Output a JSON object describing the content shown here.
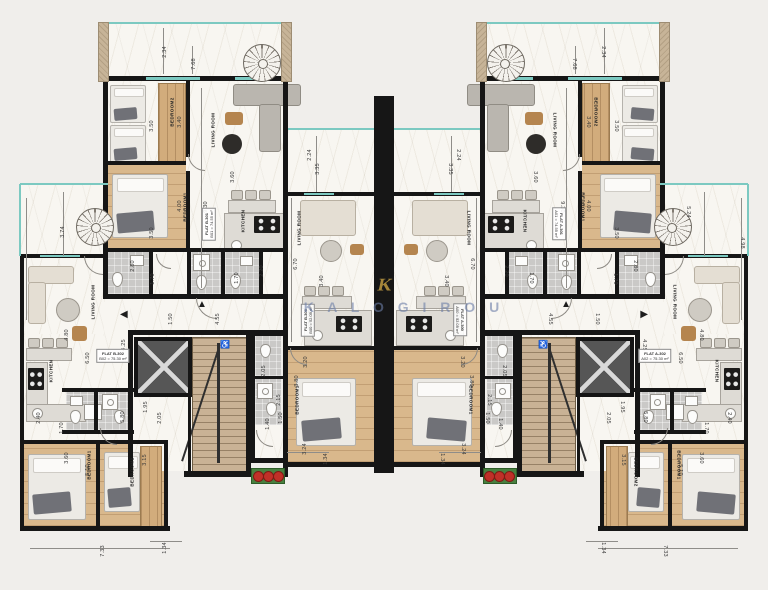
{
  "palette": {
    "wall": "#161616",
    "glass": "#7cc9c1",
    "wood": "#d9b88c",
    "gold": "#c9a344",
    "watermark": "#6c7ea8",
    "planter": "#48803f",
    "dot": "#c03028"
  },
  "watermark": {
    "text": "K A L O G I R O U",
    "logo": "K"
  },
  "glyphs": {
    "up_arrow": "▲",
    "side_arrow": "◀",
    "wheelchair": "♿"
  },
  "flat_labels": [
    {
      "l1": "FLAT B-301",
      "l2": "B01 = 74.55 m²",
      "x": 209,
      "y": 224,
      "r": -90
    },
    {
      "l1": "FLAT B-300",
      "l2": "B00 = 52.09 m²",
      "x": 308,
      "y": 320,
      "r": -90
    },
    {
      "l1": "FLAT B-302",
      "l2": "B02 = 75.30 m²",
      "x": 113,
      "y": 356,
      "r": 0
    },
    {
      "l1": "FLAT A-301",
      "l2": "A01 = 74.55 m²",
      "x": 559,
      "y": 224,
      "r": 90
    },
    {
      "l1": "FLAT A-300",
      "l2": "A00 = 52.09 m²",
      "x": 460,
      "y": 320,
      "r": 90
    },
    {
      "l1": "FLAT A-302",
      "l2": "A02 = 75.30 m²",
      "x": 655,
      "y": 356,
      "r": 0
    }
  ],
  "room_labels": [
    {
      "t": "BEDROOM2",
      "x": 172,
      "y": 112
    },
    {
      "t": "BEDROOM1",
      "x": 185,
      "y": 207
    },
    {
      "t": "LIVING ROOM",
      "x": 213,
      "y": 130
    },
    {
      "t": "KITCHEN",
      "x": 243,
      "y": 221
    },
    {
      "t": "LIVING ROOM",
      "x": 299,
      "y": 228
    },
    {
      "t": "KITCHEN",
      "x": 310,
      "y": 318
    },
    {
      "t": "BEDROOM1",
      "x": 297,
      "y": 400
    },
    {
      "t": "LIVING ROOM",
      "x": 93,
      "y": 302
    },
    {
      "t": "KITCHEN",
      "x": 51,
      "y": 371
    },
    {
      "t": "BEDROOM1",
      "x": 89,
      "y": 465
    },
    {
      "t": "BEDROOM2",
      "x": 132,
      "y": 472
    }
  ],
  "dim_labels": [
    {
      "t": "2.34",
      "x": 165,
      "y": 52
    },
    {
      "t": "7.68",
      "x": 194,
      "y": 64
    },
    {
      "t": "3.50",
      "x": 152,
      "y": 126
    },
    {
      "t": "3.40",
      "x": 180,
      "y": 122
    },
    {
      "t": "4.00",
      "x": 180,
      "y": 206
    },
    {
      "t": "3.50",
      "x": 152,
      "y": 233
    },
    {
      "t": "3.60",
      "x": 233,
      "y": 177
    },
    {
      "t": "9.30",
      "x": 206,
      "y": 207
    },
    {
      "t": "2.80",
      "x": 133,
      "y": 266
    },
    {
      "t": "1.70",
      "x": 153,
      "y": 279
    },
    {
      "t": "1.70",
      "x": 237,
      "y": 278
    },
    {
      "t": "2.20",
      "x": 262,
      "y": 271
    },
    {
      "t": "2.24",
      "x": 310,
      "y": 155
    },
    {
      "t": "3.35",
      "x": 318,
      "y": 169
    },
    {
      "t": "6.70",
      "x": 296,
      "y": 264
    },
    {
      "t": "3.40",
      "x": 322,
      "y": 281
    },
    {
      "t": "3.20",
      "x": 306,
      "y": 362
    },
    {
      "t": "3.80",
      "x": 297,
      "y": 381
    },
    {
      "t": "2.05",
      "x": 264,
      "y": 371
    },
    {
      "t": "2.15",
      "x": 279,
      "y": 400
    },
    {
      "t": "1.50",
      "x": 281,
      "y": 418
    },
    {
      "t": "1.40",
      "x": 268,
      "y": 424
    },
    {
      "t": "3.24",
      "x": 305,
      "y": 449
    },
    {
      "t": "1.34",
      "x": 326,
      "y": 459
    },
    {
      "t": "1.50",
      "x": 171,
      "y": 319
    },
    {
      "t": "4.55",
      "x": 218,
      "y": 319
    },
    {
      "t": "4.80",
      "x": 67,
      "y": 335
    },
    {
      "t": "4.25",
      "x": 124,
      "y": 345
    },
    {
      "t": "6.50",
      "x": 88,
      "y": 358
    },
    {
      "t": "2.40",
      "x": 39,
      "y": 418
    },
    {
      "t": "1.70",
      "x": 62,
      "y": 428
    },
    {
      "t": "5.80",
      "x": 123,
      "y": 417
    },
    {
      "t": "1.95",
      "x": 146,
      "y": 407
    },
    {
      "t": "2.05",
      "x": 160,
      "y": 418
    },
    {
      "t": "3.60",
      "x": 67,
      "y": 458
    },
    {
      "t": "5.10",
      "x": 88,
      "y": 470
    },
    {
      "t": "3.15",
      "x": 145,
      "y": 460
    },
    {
      "t": "7.33",
      "x": 103,
      "y": 551
    },
    {
      "t": "1.34",
      "x": 165,
      "y": 548
    },
    {
      "t": "3.74",
      "x": 63,
      "y": 232,
      "m": false
    },
    {
      "t": "4.98",
      "x": 742,
      "y": 243,
      "r": 90,
      "m": false
    },
    {
      "t": "5.24",
      "x": 688,
      "y": 212,
      "r": 90,
      "m": false
    }
  ]
}
